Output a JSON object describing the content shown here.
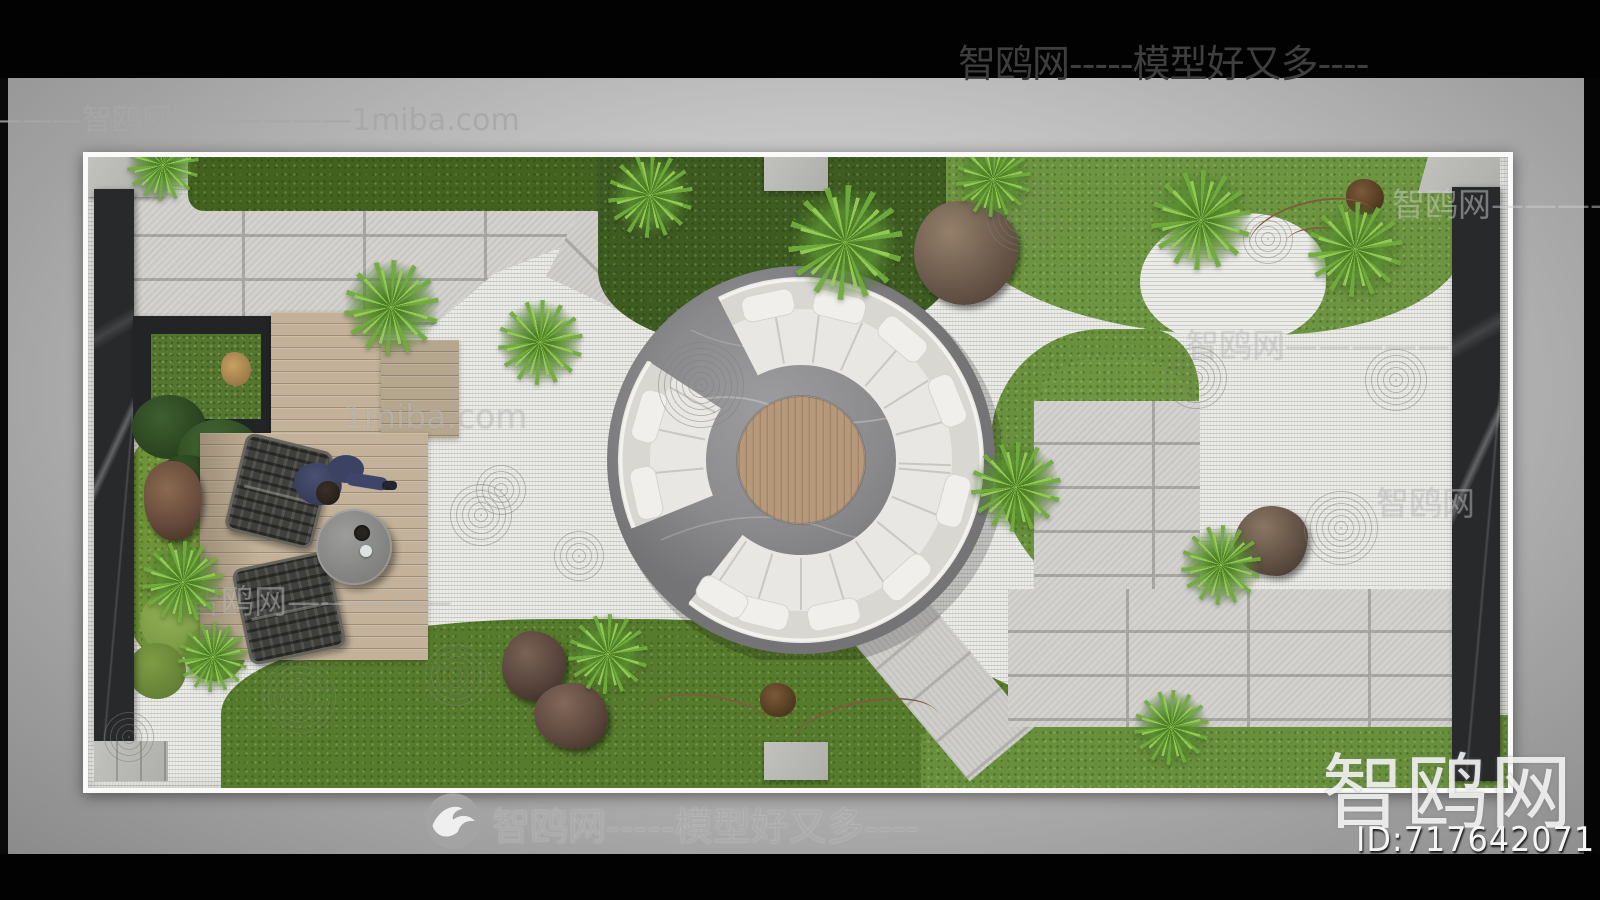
{
  "watermarks": {
    "top_bar": "智鸥网-----模型好又多----",
    "top_left": "————智鸥网——————1miba.com",
    "right_fragment": "智鸥网————",
    "bottom_center": "智鸥网-----模型好又多----",
    "logo_text": "智鸥网",
    "model_id": "ID:717642071",
    "tile_1": "1miba.com",
    "tile_2": "智鸥网—————",
    "tile_3": "智鸥网—————",
    "tile_4": "智鸥网"
  },
  "colors": {
    "top_bottom_bars": "#020202",
    "backdrop_gray": "#c6c6c6",
    "frame_white": "#fafafa",
    "gravel": "#ebebe8",
    "paver": "#d3d2cf",
    "grass": "#6d9440",
    "hedge": "#44621f",
    "deck_wood": "#c3b299",
    "dark_marble": "#27292b",
    "sofa": "#e8e7e3",
    "platform_marble": "#8e8e90",
    "table_wood": "#b6987a",
    "watermark_gray": "#ababab"
  },
  "scene": {
    "description": "top-view courtyard zen garden render with circular sofa centerpiece",
    "gravel_swirls": [
      [
        413,
        333,
        30
      ],
      [
        491,
        399,
        30
      ],
      [
        368,
        518,
        36
      ],
      [
        211,
        540,
        42
      ],
      [
        41,
        580,
        30
      ],
      [
        613,
        228,
        46
      ],
      [
        1108,
        221,
        34
      ],
      [
        1308,
        223,
        34
      ],
      [
        1253,
        371,
        38
      ],
      [
        935,
        58,
        40
      ],
      [
        1180,
        82,
        30
      ],
      [
        393,
        358,
        34
      ]
    ],
    "ferns": [
      [
        75,
        8,
        72
      ],
      [
        303,
        150,
        95
      ],
      [
        452,
        185,
        85
      ],
      [
        562,
        38,
        85
      ],
      [
        757,
        85,
        115
      ],
      [
        905,
        22,
        75
      ],
      [
        1113,
        63,
        100
      ],
      [
        1267,
        92,
        95
      ],
      [
        928,
        330,
        90
      ],
      [
        1133,
        408,
        80
      ],
      [
        520,
        497,
        80
      ],
      [
        1083,
        570,
        75
      ],
      [
        95,
        425,
        82
      ],
      [
        125,
        500,
        70
      ]
    ],
    "sofa": {
      "center": 200,
      "seat_inner_r": 98,
      "seat_outer_r": 150,
      "pillow_r": 158,
      "gaps": [
        [
          128,
          158
        ],
        [
          213,
          243
        ]
      ],
      "seat_step": 17,
      "pillow_angles": [
        15,
        48,
        78,
        104,
        120,
        168,
        196,
        258,
        284,
        310,
        338
      ]
    }
  }
}
